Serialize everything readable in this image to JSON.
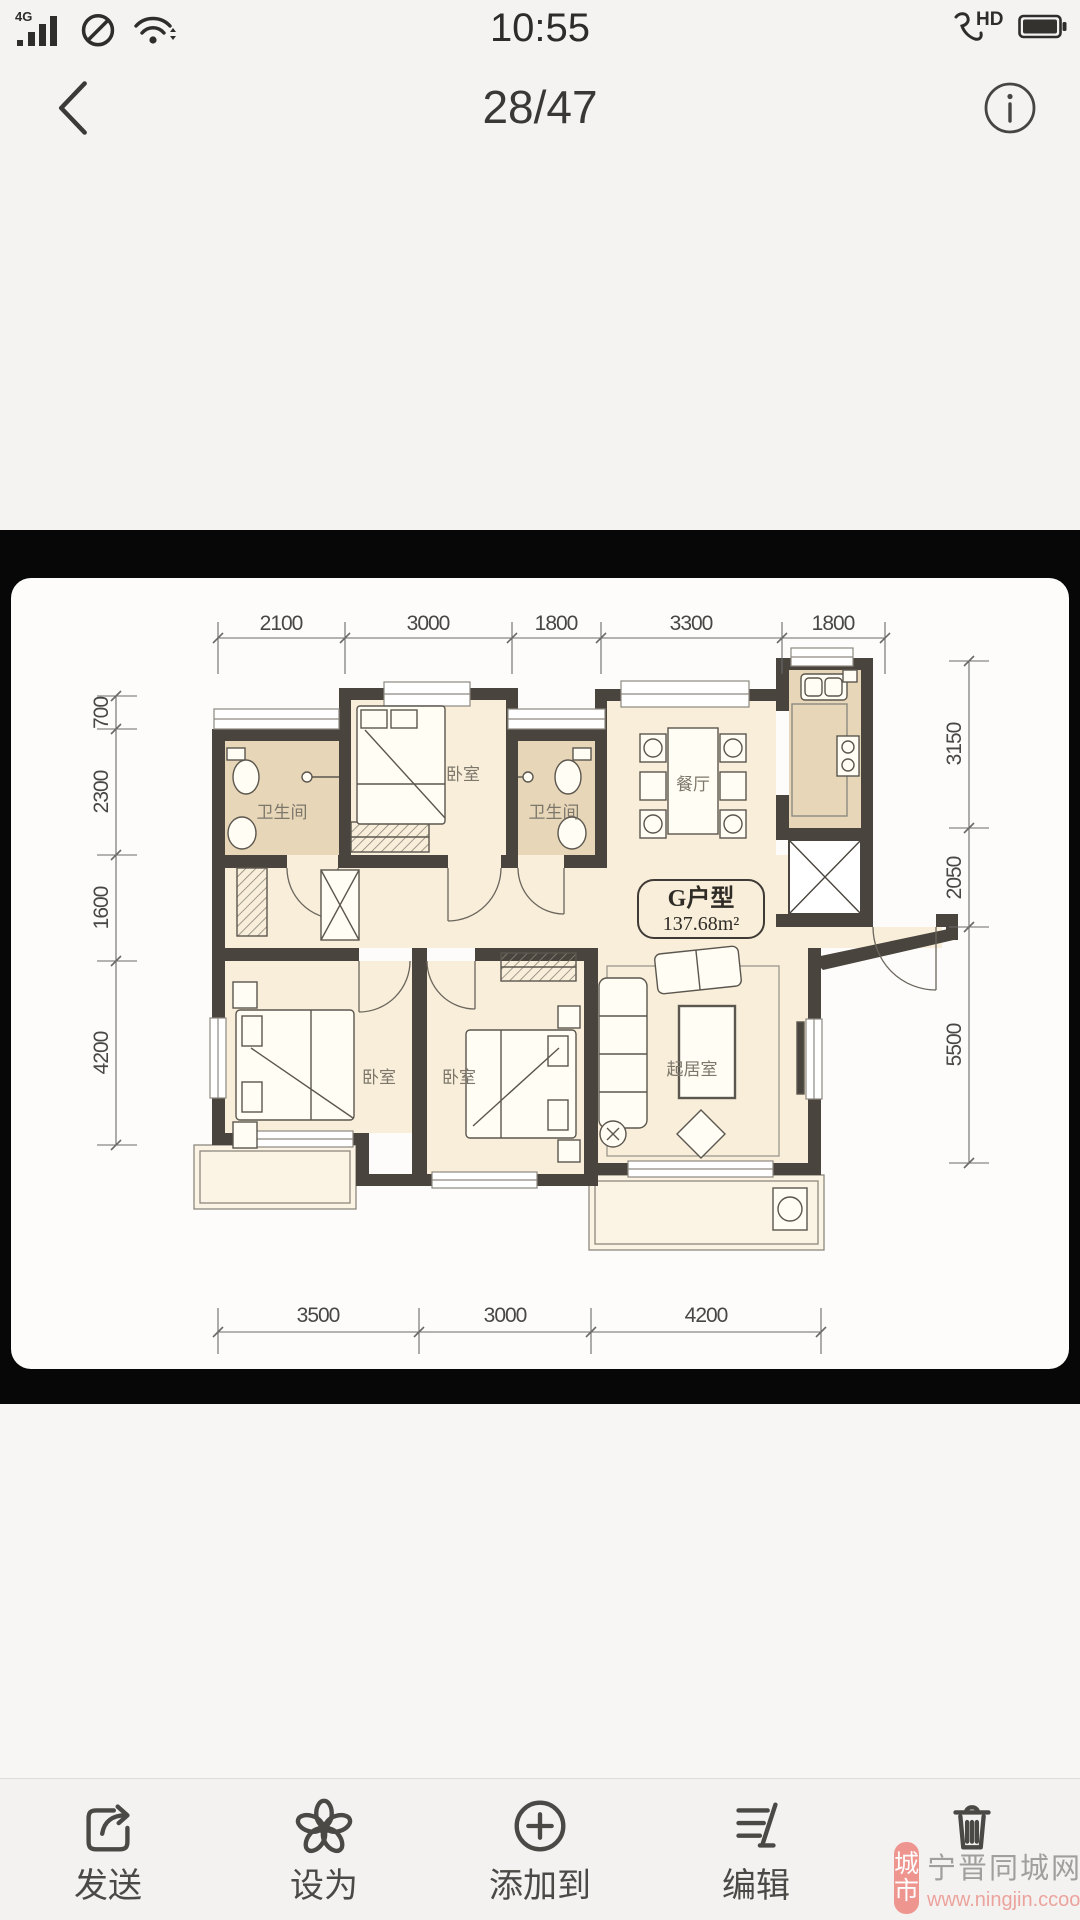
{
  "status_bar": {
    "time": "10:55",
    "network_badge": "4G",
    "volte_label": "HD"
  },
  "nav_bar": {
    "photo_counter": "28/47"
  },
  "photo": {
    "plan_title": "G户型",
    "plan_area": "137.68m²",
    "room_labels": {
      "bath1": "卫生间",
      "bed1": "卧室",
      "bath2": "卫生间",
      "dining": "餐厅",
      "bed2": "卧室",
      "bed3": "卧室",
      "living": "起居室"
    },
    "dims_top": [
      "2100",
      "3000",
      "1800",
      "3300",
      "1800"
    ],
    "dims_left": [
      "700",
      "2300",
      "1600",
      "4200"
    ],
    "dims_right": [
      "3150",
      "2050",
      "5500"
    ],
    "dims_bottom": [
      "3500",
      "3000",
      "4200"
    ]
  },
  "toolbar": {
    "items": [
      {
        "name": "send",
        "label": "发送"
      },
      {
        "name": "set-as",
        "label": "设为"
      },
      {
        "name": "add-to",
        "label": "添加到"
      },
      {
        "name": "edit",
        "label": "编辑"
      },
      {
        "name": "delete",
        "label": ""
      }
    ]
  },
  "watermark": {
    "seal_text_1": "城",
    "seal_text_2": "市",
    "site_name": "宁晋同城网",
    "site_url": "www.ningjin.ccoo.cn"
  },
  "colors": {
    "wall": "#49443d",
    "room_cream": "#f8eeda",
    "room_tan": "#e7d7b8",
    "watermark_pink": "#ee8e87",
    "viewer_bg": "#070707"
  }
}
